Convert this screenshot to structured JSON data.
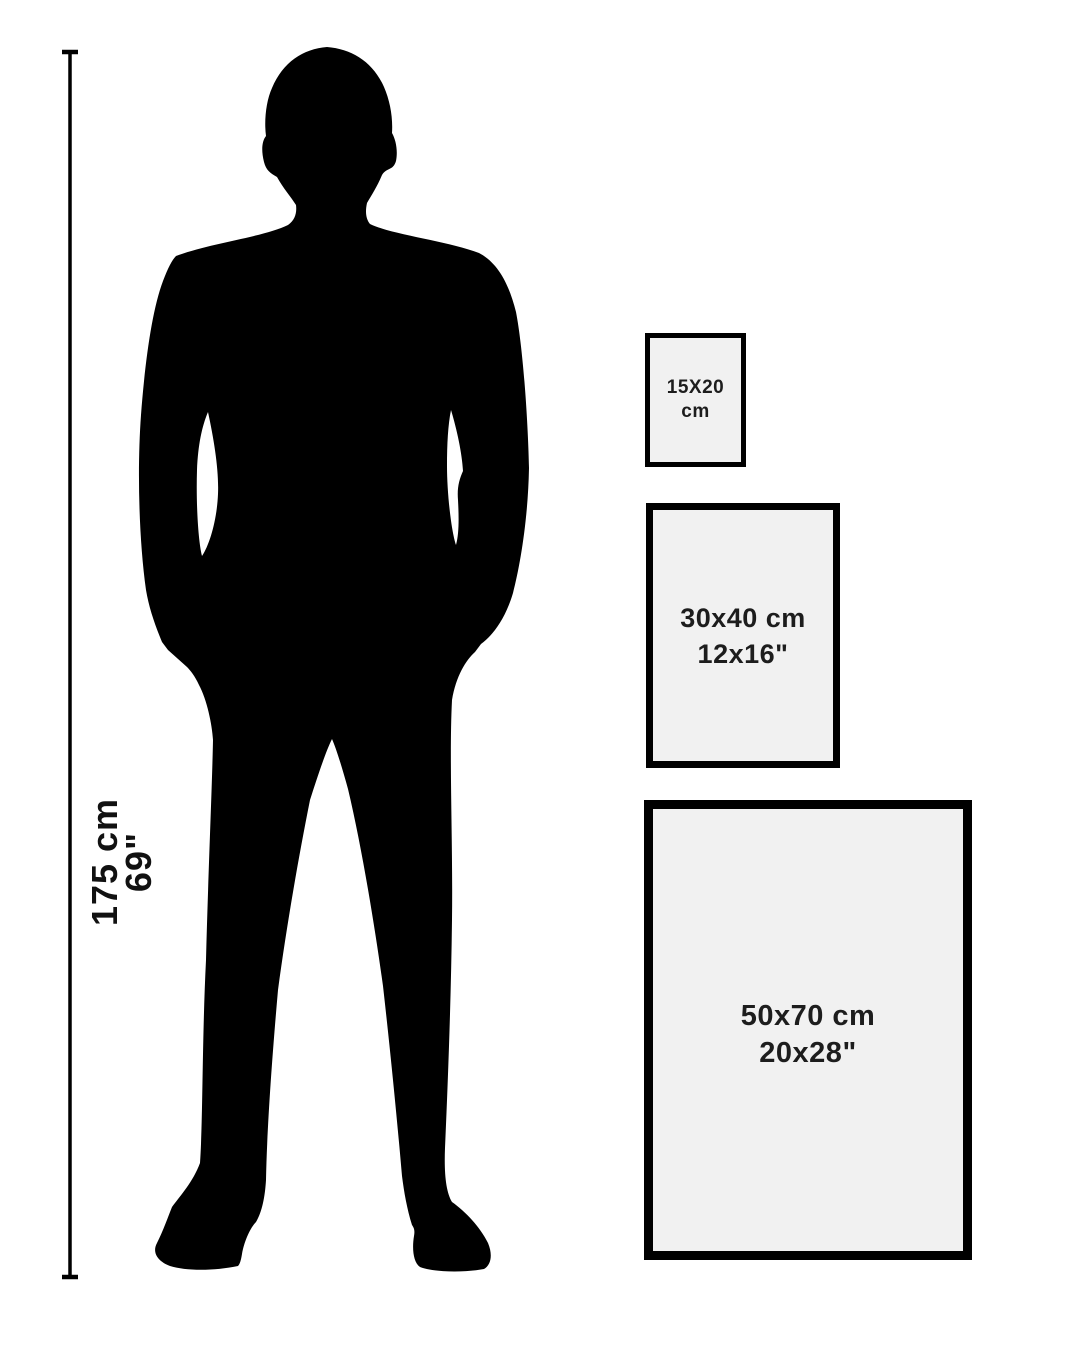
{
  "size_guide": {
    "person": {
      "height_cm": "175 cm",
      "height_in": "69\""
    },
    "frames": [
      {
        "name": "small",
        "line1": "15X20 cm",
        "line2": ""
      },
      {
        "name": "medium",
        "line1": "30x40 cm",
        "line2": "12x16\""
      },
      {
        "name": "large",
        "line1": "50x70 cm",
        "line2": "20x28\""
      }
    ],
    "colors": {
      "background": "#ffffff",
      "silhouette": "#000000",
      "frame_fill": "#f1f1f1",
      "frame_border": "#000000",
      "text": "#1d1d1d"
    }
  }
}
